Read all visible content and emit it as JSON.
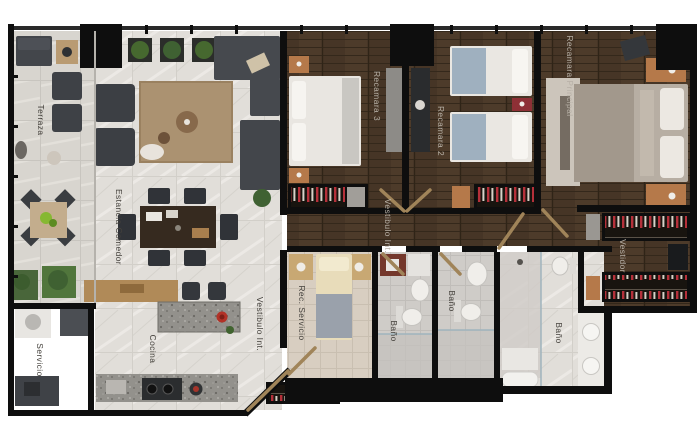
{
  "plan": {
    "kind": "apartment-floorplan-render-top-view",
    "labels": [
      {
        "id": "terraza",
        "text": "Terraza"
      },
      {
        "id": "estancia-comedor",
        "text": "Estancia Comedor"
      },
      {
        "id": "servicio",
        "text": "Servicio"
      },
      {
        "id": "cocina",
        "text": "Cocina"
      },
      {
        "id": "vestibulo-entrada",
        "text": "Vestibulo Int."
      },
      {
        "id": "rec-servicio",
        "text": "Rec. Servicio"
      },
      {
        "id": "bano-servicio",
        "text": "Baño"
      },
      {
        "id": "vestibulo-recamaras",
        "text": "Vestibulo Int."
      },
      {
        "id": "recamara-3",
        "text": "Recamara 3"
      },
      {
        "id": "recamara-2",
        "text": "Recamara 2"
      },
      {
        "id": "recamara-principal",
        "text": "Recamara Principal"
      },
      {
        "id": "bano-secundario",
        "text": "Baño"
      },
      {
        "id": "bano-principal",
        "text": "Baño"
      },
      {
        "id": "vestidor",
        "text": "Vestidor"
      }
    ],
    "colors": {
      "background": "#ffffff",
      "walls": "#0e0e0e",
      "wood_floor": "#463526",
      "marble_floor": "#e1ded9",
      "terrace_stone": "#d8d5cf",
      "bath_tile": "#cfccc8",
      "service_room_tile": "#d8cec1",
      "granite_counter": "#93918c",
      "wood_accent": "#b5794a",
      "clothes_red": "#b5303a",
      "sofa_gray": "#46494e",
      "label_dark": "#44413c",
      "label_light": "#b7b0a6"
    }
  }
}
